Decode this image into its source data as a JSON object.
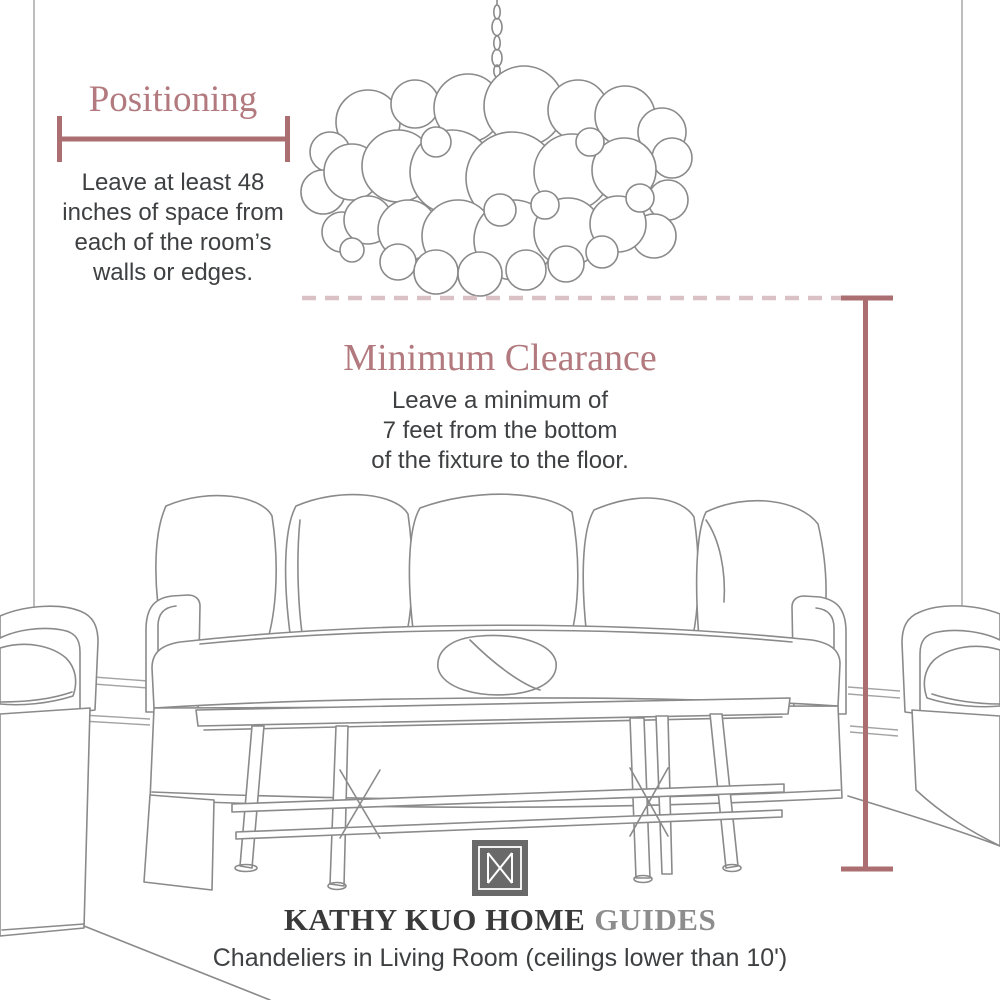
{
  "theme": {
    "background": "#ffffff",
    "accent": "#b27a7e",
    "measure_line": "#ab6f72",
    "dashed_line": "#d9c1c6",
    "body_text": "#3e4042",
    "sketch": "#8a8a8a",
    "brand_dark": "#3a3a3a",
    "brand_light": "#8d8d8d",
    "logo_bg": "#696969"
  },
  "positioning": {
    "title": "Positioning",
    "lines": [
      "Leave at least 48",
      "inches of space from",
      "each of the room’s",
      "walls or edges."
    ]
  },
  "clearance": {
    "title": "Minimum Clearance",
    "lines": [
      "Leave a minimum of",
      "7 feet from the bottom",
      "of the fixture to the floor."
    ]
  },
  "footer": {
    "logo_icon": "kathy-kuo-home-monogram",
    "brand": "KATHY KUO HOME",
    "brand_suffix": "GUIDES",
    "caption": "Chandeliers in Living Room (ceilings lower than 10')"
  },
  "illustrations": {
    "chandelier": "bubble-chandelier-sketch",
    "sofa": "slipcovered-sofa-sketch",
    "coffee_table": "bamboo-coffee-table-sketch",
    "left_armchair": "armchair-sketch",
    "right_armchair": "armchair-sketch",
    "room": "wall-edge-lines"
  }
}
